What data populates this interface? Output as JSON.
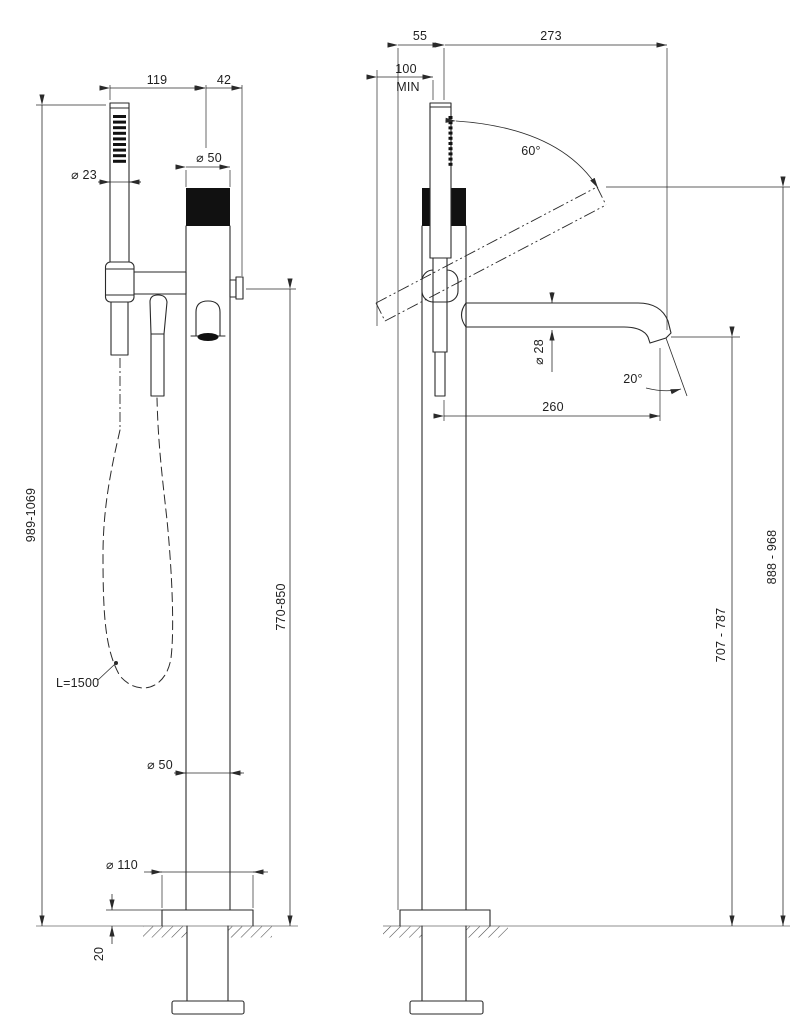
{
  "drawing": {
    "subject": "floor-mounted bath mixer column with hand shower — two-view dimension drawing",
    "colors": {
      "background": "#ffffff",
      "lines": "#2a2a2a",
      "floor_line": "#8f8f8f",
      "solid_fill": "#111111"
    }
  },
  "dims": {
    "front": {
      "span_left": "119",
      "span_right": "42",
      "handshower_dia": "⌀ 23",
      "handle_dia": "⌀ 50",
      "overall_height": "989-1069",
      "body_height": "770-850",
      "hose_length": "L=1500",
      "column_dia": "⌀ 50",
      "base_dia": "⌀ 110",
      "base_plate_height": "20"
    },
    "side": {
      "flange_to_axis": "55",
      "max_reach": "273",
      "wall_clearance": "100",
      "wall_clearance_note": "MIN",
      "handshower_angle": "60°",
      "spout_dia": "⌀ 28",
      "outlet_angle": "20°",
      "spout_reach": "260",
      "raised_handshower_height": "888 - 968",
      "spout_outlet_height": "707 - 787"
    }
  }
}
